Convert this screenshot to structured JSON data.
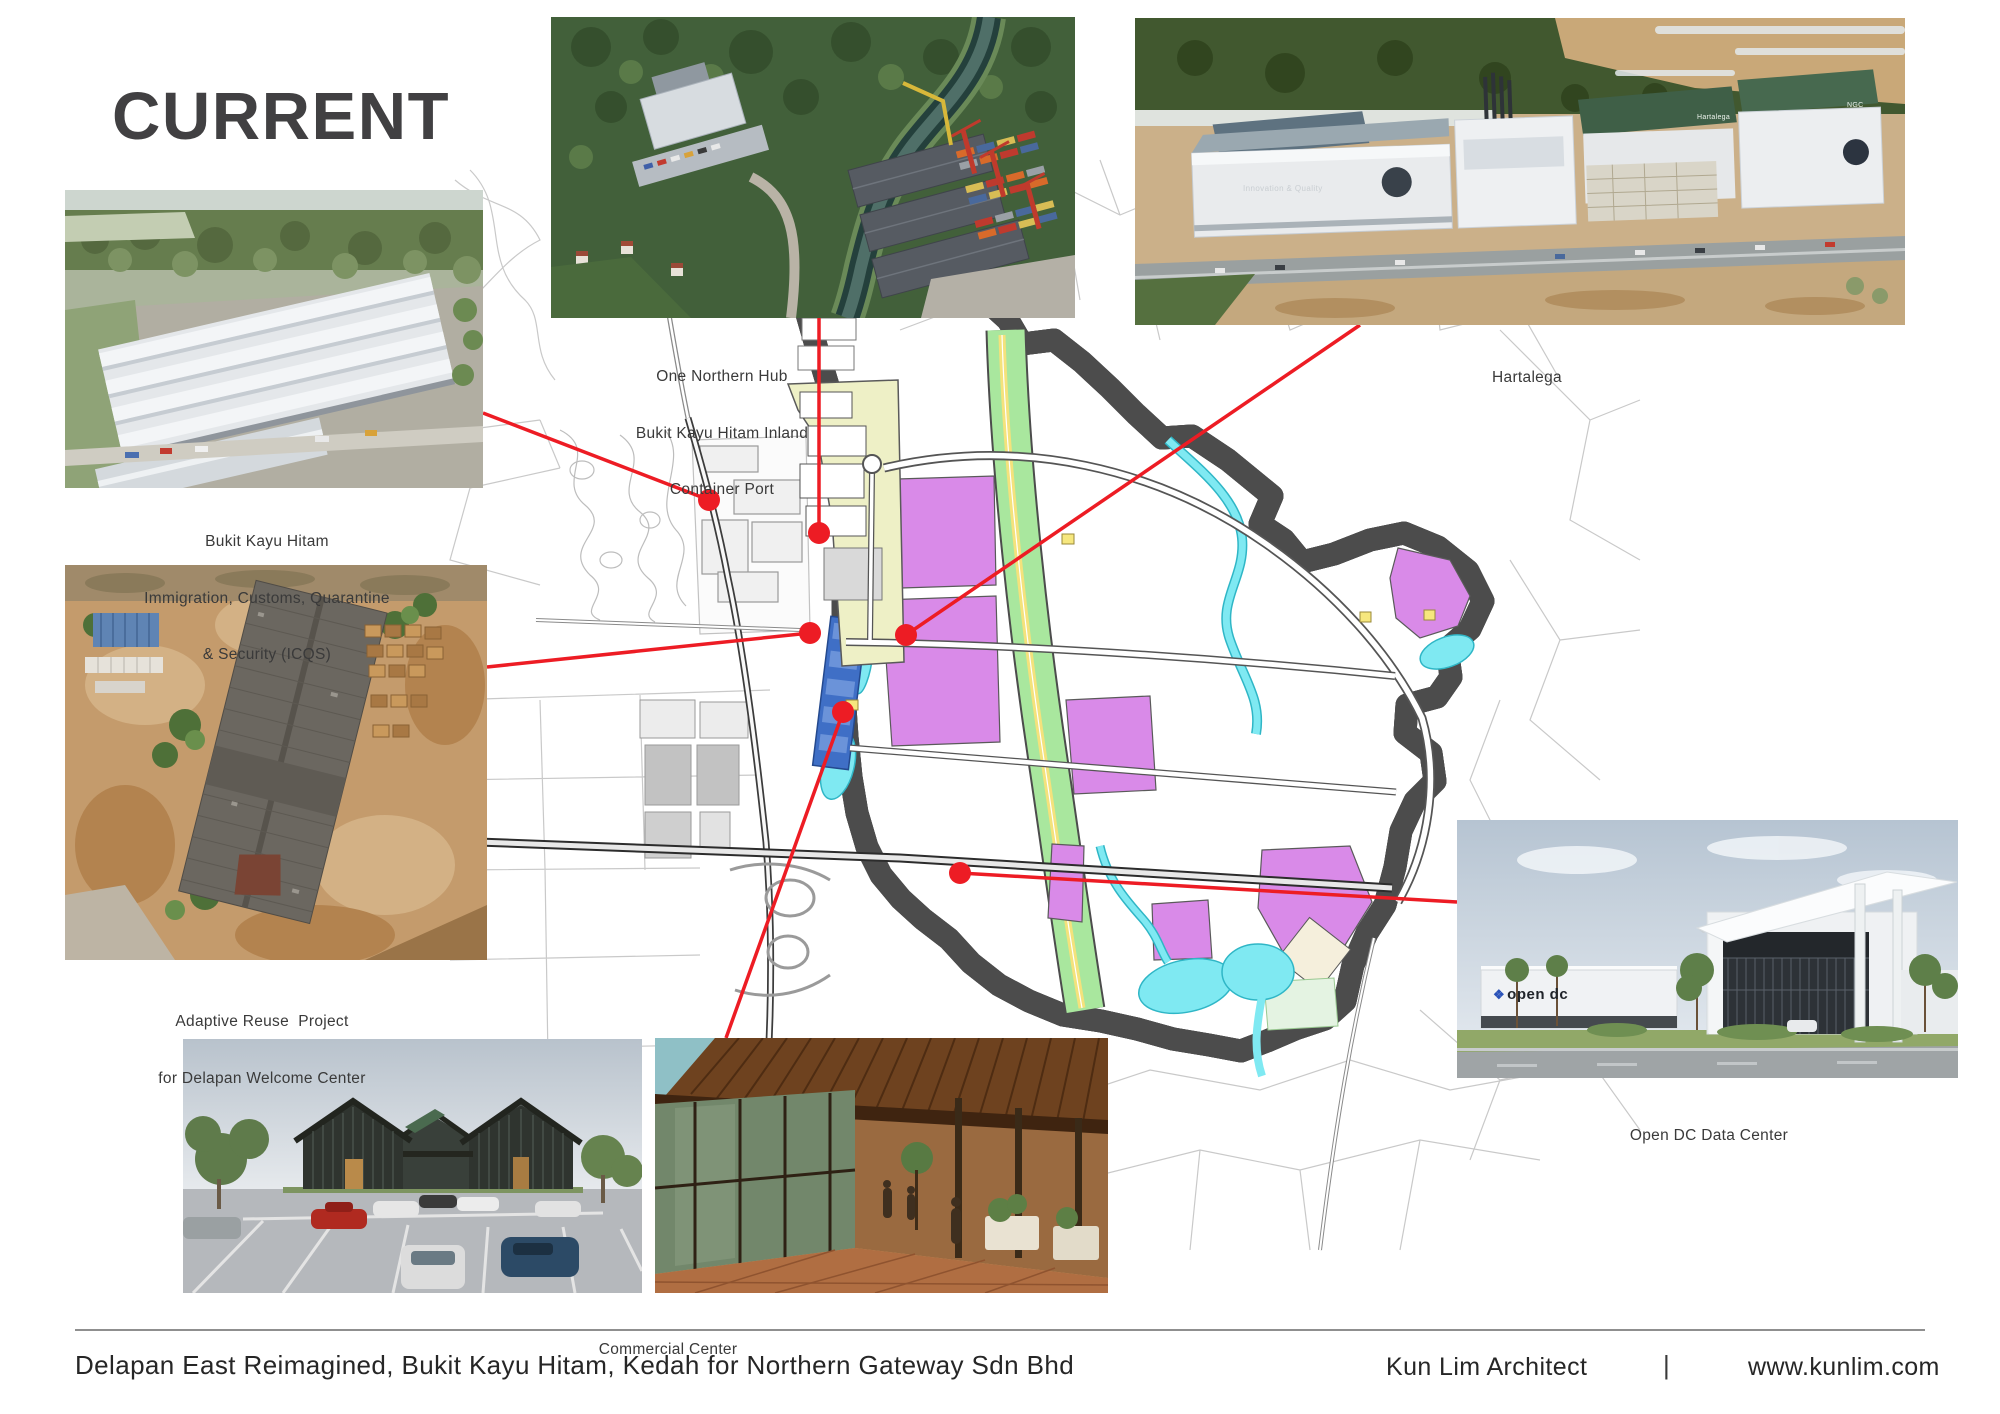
{
  "title": "CURRENT",
  "captions": {
    "container_port": [
      "One Northern Hub",
      "Bukit Kayu Hitam Inland",
      "Container Port"
    ],
    "hartalega": [
      "Hartalega"
    ],
    "icqs": [
      "Bukit Kayu Hitam",
      "Immigration, Customs, Quarantine",
      "& Security (ICQS)"
    ],
    "adaptive_reuse": [
      "Adaptive Reuse  Project",
      "for Delapan Welcome Center"
    ],
    "commercial": [
      "Commercial Center"
    ],
    "open_dc": [
      "Open DC Data Center"
    ]
  },
  "photo_labels": {
    "hartalega_facade": "Innovation & Quality",
    "hartalega_sign": "Hartalega",
    "hartalega_ngc": "NGC",
    "open_dc_logo": "open dc"
  },
  "icons": {
    "open_dc_logo_icon": "❖"
  },
  "footer": {
    "project": "Delapan East Reimagined, Bukit Kayu Hitam, Kedah for Northern Gateway Sdn Bhd",
    "architect": "Kun Lim Architect",
    "separator": "|",
    "website": "www.kunlim.com"
  },
  "map": {
    "marker_color": "#ed1c24",
    "markers": [
      "one-northern-hub-inland-container-port",
      "bukit-kayu-hitam-icqs",
      "hartalega",
      "adaptive-reuse-welcome-center",
      "commercial-center",
      "open-dc-data-center"
    ]
  },
  "colors": {
    "title": "#414042",
    "accent_red": "#ed1c24",
    "plan_pink": "#fbeaf8",
    "plan_magenta": "#d98ae8",
    "plan_green": "#a9e79e",
    "plan_water": "#7fe9f2",
    "plan_blue": "#3f6fc6",
    "plan_yellow": "#f4e27c",
    "plan_khaki": "#eef0c6"
  }
}
